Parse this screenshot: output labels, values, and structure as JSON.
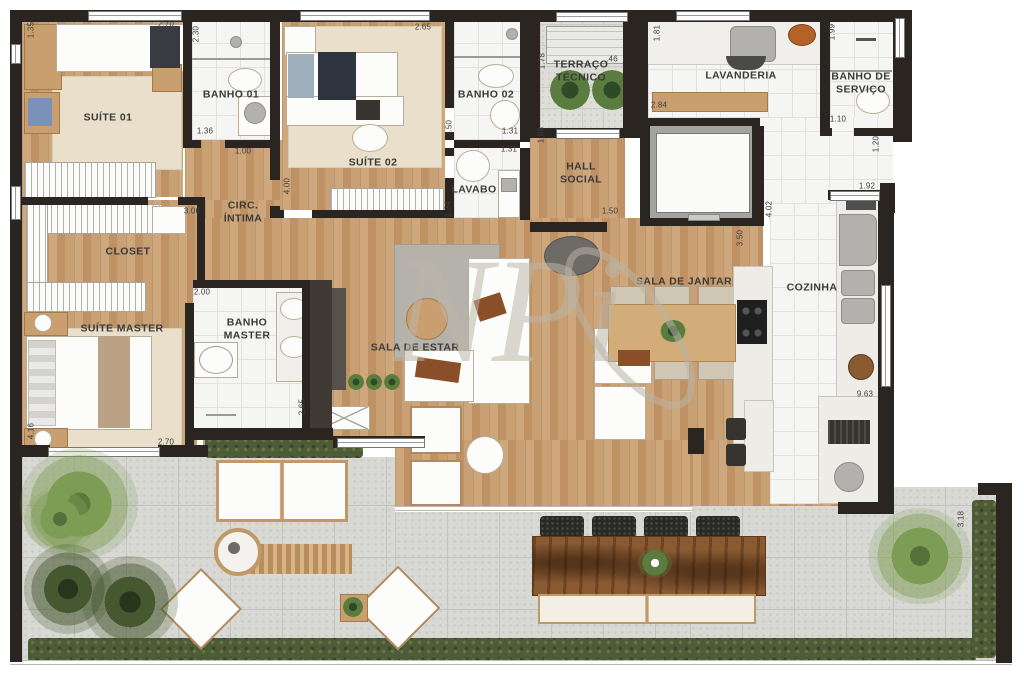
{
  "document": {
    "type": "apartment-floor-plan"
  },
  "watermark": {
    "text": "NPi"
  },
  "colors": {
    "wall": "#2b2521",
    "wood_floor": "#c59a6c",
    "bath_tile": "#f5f5f3",
    "terrace_stone": "#d8d8d4",
    "hedge_green": "#4d5b36",
    "rug_beige": "#eadfca",
    "rustic_table": "#8a5a33",
    "watermark_gray": "#bcb6aa"
  },
  "plan": {
    "rooms": [
      {
        "id": "suite-01",
        "label": "SUÍTE 01",
        "x": 108,
        "y": 118
      },
      {
        "id": "banho-01",
        "label": "BANHO 01",
        "x": 231,
        "y": 95
      },
      {
        "id": "suite-02",
        "label": "SUÍTE 02",
        "x": 373,
        "y": 163
      },
      {
        "id": "banho-02",
        "label": "BANHO 02",
        "x": 486,
        "y": 95
      },
      {
        "id": "lavabo",
        "label": "LAVABO",
        "x": 474,
        "y": 190
      },
      {
        "id": "terraco-tecnico",
        "label": "TERRAÇO\nTÉCNICO",
        "x": 581,
        "y": 71
      },
      {
        "id": "hall-social",
        "label": "HALL\nSOCIAL",
        "x": 581,
        "y": 173
      },
      {
        "id": "lavanderia",
        "label": "LAVANDERIA",
        "x": 741,
        "y": 76
      },
      {
        "id": "banho-de-servico",
        "label": "BANHO DE\nSERVIÇO",
        "x": 861,
        "y": 83
      },
      {
        "id": "circ-intima",
        "label": "CIRC.\nÍNTIMA",
        "x": 243,
        "y": 212
      },
      {
        "id": "closet",
        "label": "CLOSET",
        "x": 128,
        "y": 252
      },
      {
        "id": "suite-master",
        "label": "SUÍTE MASTER",
        "x": 122,
        "y": 329
      },
      {
        "id": "banho-master",
        "label": "BANHO\nMASTER",
        "x": 247,
        "y": 329
      },
      {
        "id": "sala-de-estar",
        "label": "SALA DE ESTAR",
        "x": 415,
        "y": 348
      },
      {
        "id": "sala-de-jantar",
        "label": "SALA DE JANTAR",
        "x": 684,
        "y": 282
      },
      {
        "id": "cozinha",
        "label": "COZINHA",
        "x": 812,
        "y": 288
      }
    ],
    "dimensions": [
      {
        "text": "2.70",
        "x": 166,
        "y": 24,
        "rot": 0
      },
      {
        "text": "1.35",
        "x": 31,
        "y": 30,
        "rot": -90
      },
      {
        "text": "2.30",
        "x": 196,
        "y": 34,
        "rot": -90
      },
      {
        "text": "1.36",
        "x": 205,
        "y": 131,
        "rot": 0
      },
      {
        "text": "1.00",
        "x": 243,
        "y": 151,
        "rot": 0
      },
      {
        "text": "3.06",
        "x": 192,
        "y": 211,
        "rot": 0
      },
      {
        "text": "4.00",
        "x": 287,
        "y": 186,
        "rot": -90
      },
      {
        "text": "2.65",
        "x": 423,
        "y": 27,
        "rot": 0
      },
      {
        "text": "2.50",
        "x": 449,
        "y": 128,
        "rot": -90
      },
      {
        "text": "1.31",
        "x": 510,
        "y": 131,
        "rot": 0
      },
      {
        "text": "1.31",
        "x": 509,
        "y": 149,
        "rot": 0
      },
      {
        "text": "1.34",
        "x": 448,
        "y": 209,
        "rot": -90
      },
      {
        "text": "1.78",
        "x": 542,
        "y": 61,
        "rot": -90
      },
      {
        "text": ".46",
        "x": 612,
        "y": 59,
        "rot": 0
      },
      {
        "text": "1.88",
        "x": 541,
        "y": 135,
        "rot": -90
      },
      {
        "text": "1.50",
        "x": 610,
        "y": 211,
        "rot": 0
      },
      {
        "text": "1.81",
        "x": 657,
        "y": 33,
        "rot": -90
      },
      {
        "text": "2.84",
        "x": 659,
        "y": 105,
        "rot": 0
      },
      {
        "text": "1.99",
        "x": 832,
        "y": 32,
        "rot": -90
      },
      {
        "text": "1.10",
        "x": 838,
        "y": 119,
        "rot": 0
      },
      {
        "text": "1.20",
        "x": 876,
        "y": 144,
        "rot": -90
      },
      {
        "text": "1.92",
        "x": 867,
        "y": 186,
        "rot": 0
      },
      {
        "text": "4.02",
        "x": 769,
        "y": 209,
        "rot": -90
      },
      {
        "text": "3.50",
        "x": 740,
        "y": 238,
        "rot": -90
      },
      {
        "text": "9.63",
        "x": 865,
        "y": 394,
        "rot": 0
      },
      {
        "text": "2.00",
        "x": 202,
        "y": 292,
        "rot": 0
      },
      {
        "text": "2.65",
        "x": 302,
        "y": 407,
        "rot": -90
      },
      {
        "text": "2.70",
        "x": 166,
        "y": 442,
        "rot": 0
      },
      {
        "text": "4.16",
        "x": 31,
        "y": 431,
        "rot": -90
      },
      {
        "text": "3.18",
        "x": 961,
        "y": 519,
        "rot": -90
      }
    ]
  }
}
